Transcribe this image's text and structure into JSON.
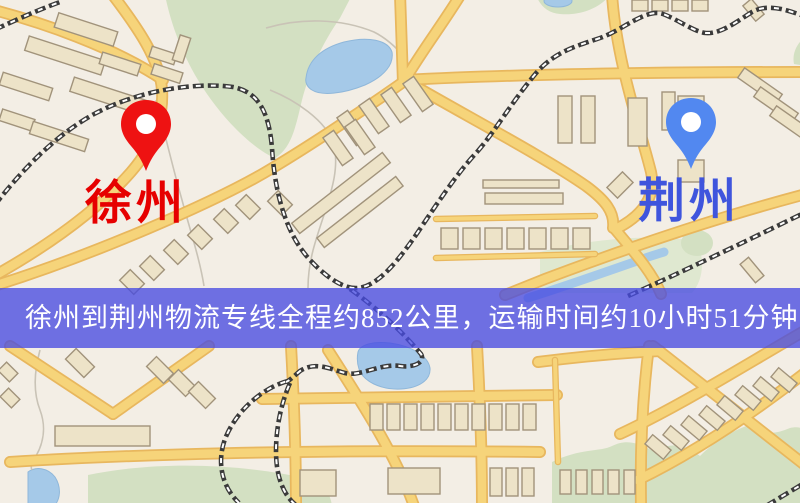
{
  "banner": {
    "text": "徐州到荆州物流专线全程约852公里，运输时间约10小时51分钟."
  },
  "markers": {
    "origin": {
      "label": "徐州",
      "pin_color": "#ee1212",
      "label_color": "#e60000"
    },
    "destination": {
      "label": "荆州",
      "pin_color": "#5288f0",
      "label_color": "#3f55dd"
    }
  },
  "map": {
    "colors": {
      "bg": "#f3eee5",
      "park": "#d3e0c2",
      "park_light": "#dfe8d0",
      "water": "#a5c9e8",
      "water_edge": "#8fb7da",
      "road_fill": "#f6d47a",
      "road_casing": "#e8b75e",
      "rail": "#3a3a3a",
      "rail_tie": "#ffffff",
      "building": "#ede3c8",
      "building_edge": "#a1937b",
      "stream": "#c9c3b6",
      "banner_bg": "rgba(72,76,226,0.78)",
      "banner_text": "#ffffff"
    }
  }
}
